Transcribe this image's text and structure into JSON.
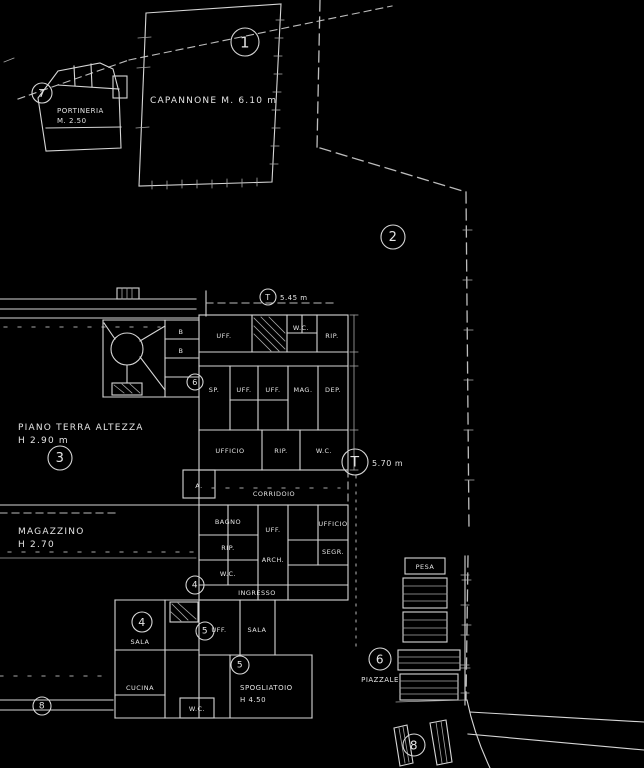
{
  "colors": {
    "background": "#000000",
    "line": "#d6d6d6",
    "text": "#e4e4e4"
  },
  "labels": {
    "capannone": "CAPANNONE M. 6.10 m",
    "portineria_1": "PORTINERIA",
    "portineria_2": "M. 2.50",
    "gate_dim": "5.45 m",
    "section_dim": "5.70 m",
    "piano_terra_1": "PIANO TERRA ALTEZZA",
    "piano_terra_2": "H 2.90 m",
    "magazzino_1": "MAGAZZINO",
    "magazzino_2": "H 2.70",
    "spogliatoio_1": "SPOGLIATOIO",
    "spogliatoio_2": "H 4.50",
    "piazzale": "PIAZZALE"
  },
  "markers": [
    {
      "label": "1",
      "x": 245,
      "y": 42,
      "r": 14
    },
    {
      "label": "7",
      "x": 42,
      "y": 93,
      "r": 10
    },
    {
      "label": "2",
      "x": 393,
      "y": 237,
      "r": 12
    },
    {
      "label": "T",
      "x": 268,
      "y": 297,
      "r": 8
    },
    {
      "label": "3",
      "x": 60,
      "y": 458,
      "r": 12
    },
    {
      "label": "6",
      "x": 195,
      "y": 382,
      "r": 8
    },
    {
      "label": "T",
      "x": 355,
      "y": 462,
      "r": 13
    },
    {
      "label": "4",
      "x": 195,
      "y": 585,
      "r": 9
    },
    {
      "label": "4",
      "x": 142,
      "y": 622,
      "r": 10
    },
    {
      "label": "5",
      "x": 205,
      "y": 631,
      "r": 9
    },
    {
      "label": "5",
      "x": 240,
      "y": 665,
      "r": 9
    },
    {
      "label": "6",
      "x": 380,
      "y": 659,
      "r": 11
    },
    {
      "label": "8",
      "x": 42,
      "y": 706,
      "r": 9
    },
    {
      "label": "8",
      "x": 414,
      "y": 745,
      "r": 11
    }
  ],
  "rooms": [
    {
      "label": "UFF.",
      "x": 224,
      "y": 338
    },
    {
      "label": "W.C.",
      "x": 301,
      "y": 330
    },
    {
      "label": "RIP.",
      "x": 332,
      "y": 338
    },
    {
      "label": "B",
      "x": 181,
      "y": 334
    },
    {
      "label": "B",
      "x": 181,
      "y": 353
    },
    {
      "label": "SP.",
      "x": 214,
      "y": 392
    },
    {
      "label": "UFF.",
      "x": 244,
      "y": 392
    },
    {
      "label": "UFF.",
      "x": 273,
      "y": 392
    },
    {
      "label": "MAG.",
      "x": 303,
      "y": 392
    },
    {
      "label": "DEP.",
      "x": 333,
      "y": 392
    },
    {
      "label": "UFFICIO",
      "x": 230,
      "y": 453
    },
    {
      "label": "RIP.",
      "x": 281,
      "y": 453
    },
    {
      "label": "W.C.",
      "x": 324,
      "y": 453
    },
    {
      "label": "A.",
      "x": 199,
      "y": 488
    },
    {
      "label": "CORRIDOIO",
      "x": 274,
      "y": 496
    },
    {
      "label": "BAGNO",
      "x": 228,
      "y": 524
    },
    {
      "label": "RIP.",
      "x": 228,
      "y": 550
    },
    {
      "label": "W.C.",
      "x": 228,
      "y": 576
    },
    {
      "label": "UFF.",
      "x": 273,
      "y": 532
    },
    {
      "label": "ARCH.",
      "x": 273,
      "y": 562
    },
    {
      "label": "UFFICIO",
      "x": 333,
      "y": 526
    },
    {
      "label": "SEGR.",
      "x": 333,
      "y": 554
    },
    {
      "label": "INGRESSO",
      "x": 257,
      "y": 595
    },
    {
      "label": "UFF.",
      "x": 219,
      "y": 632
    },
    {
      "label": "SALA",
      "x": 257,
      "y": 632
    },
    {
      "label": "SALA",
      "x": 140,
      "y": 644
    },
    {
      "label": "CUCINA",
      "x": 140,
      "y": 690
    },
    {
      "label": "W.C.",
      "x": 197,
      "y": 711
    },
    {
      "label": "PESA",
      "x": 425,
      "y": 569
    }
  ]
}
